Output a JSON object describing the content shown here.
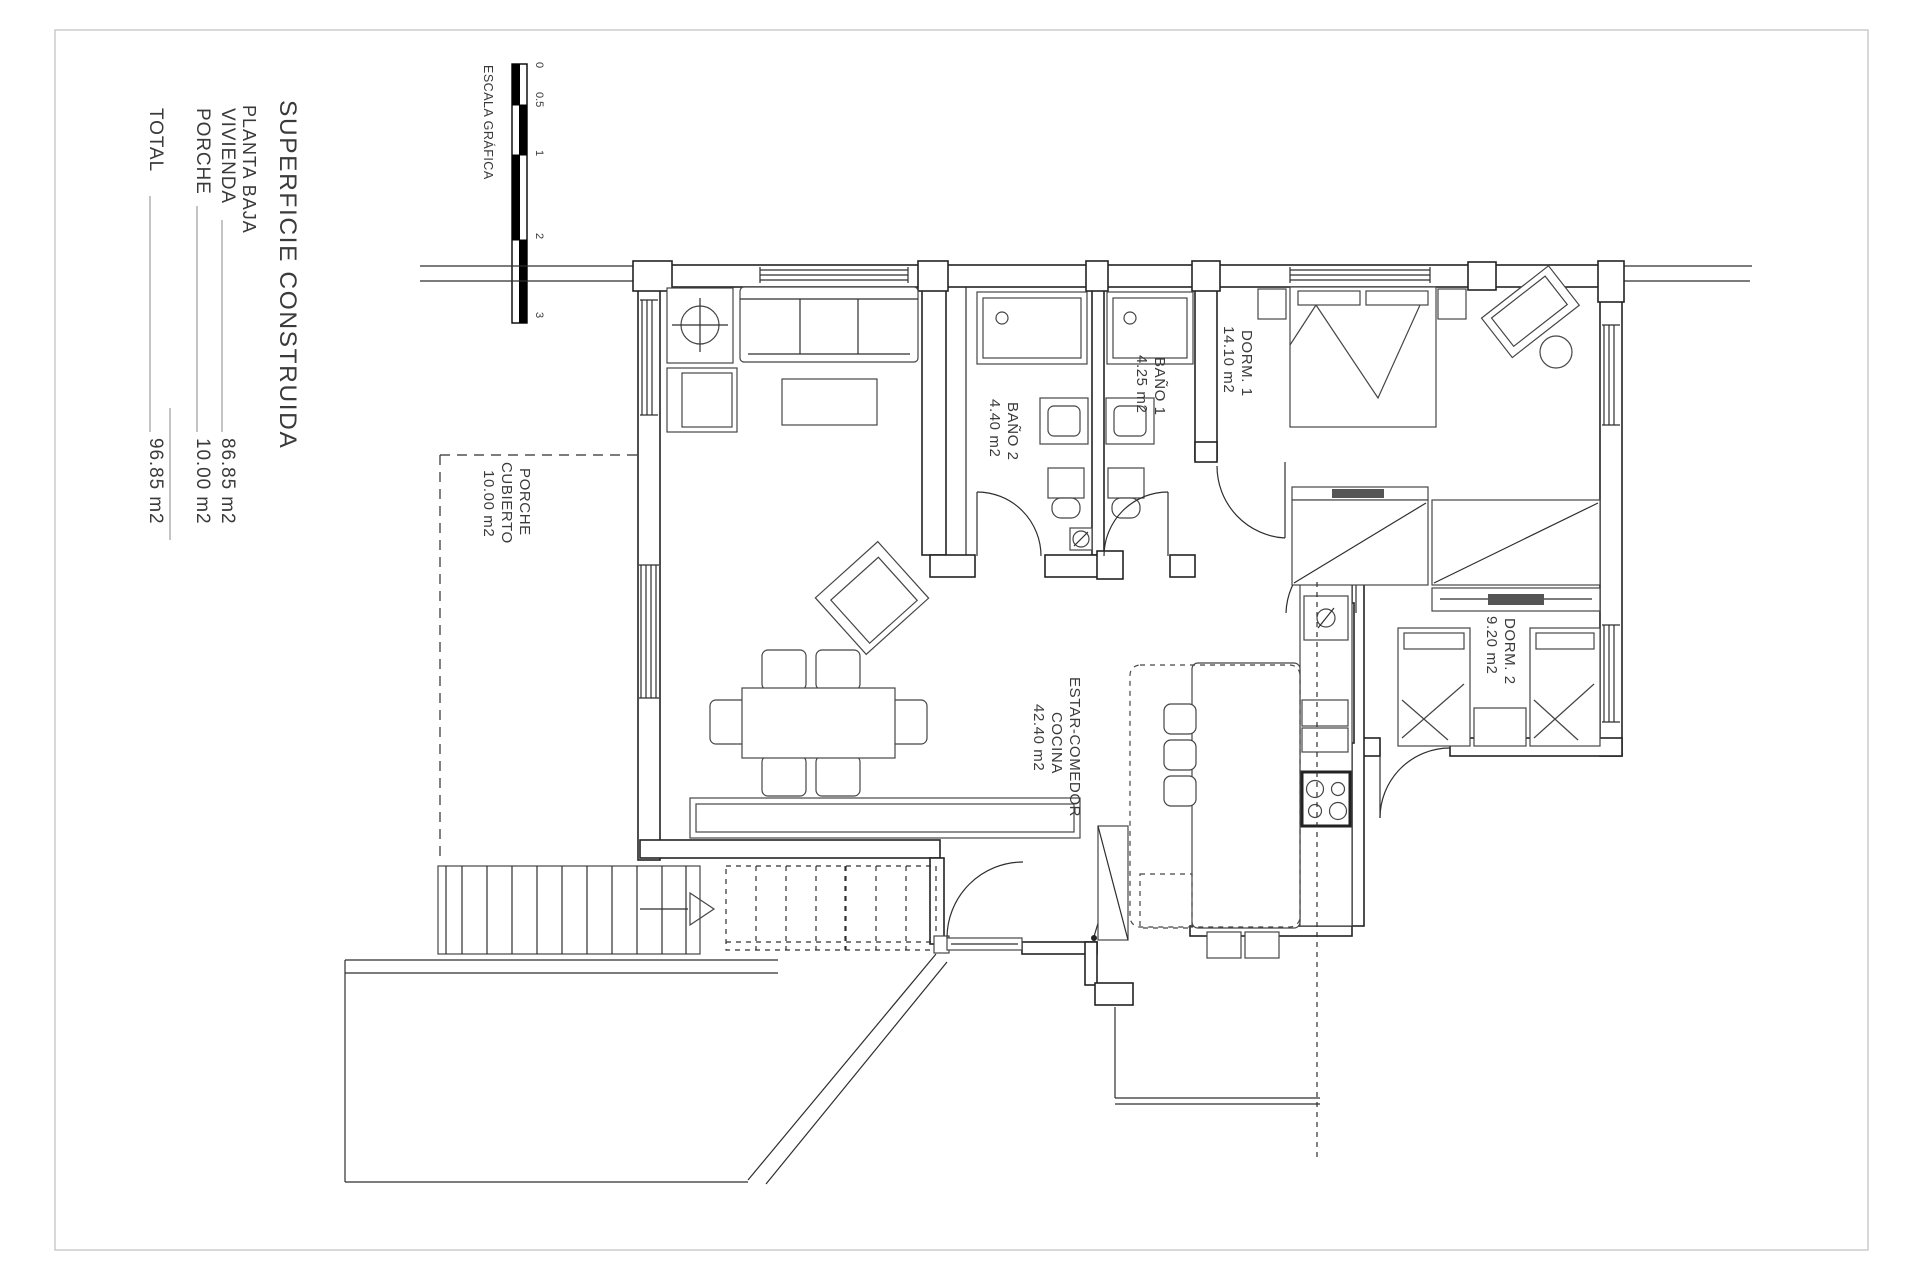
{
  "title_block": {
    "title": "SUPERFICIE CONSTRUIDA",
    "subtitle": "PLANTA BAJA",
    "rows": [
      {
        "label": "VIVIENDA",
        "value": "86.85 m2"
      },
      {
        "label": "PORCHE",
        "value": "10.00 m2"
      },
      {
        "label": "TOTAL",
        "value": "96.85 m2"
      }
    ]
  },
  "scale_bar": {
    "label": "ESCALA GRÁFICA",
    "ticks": [
      "0",
      "0.5",
      "1",
      "2",
      "3"
    ]
  },
  "rooms": [
    {
      "name_line1": "ESTAR-COMEDOR",
      "name_line2": "COCINA",
      "area": "42.40 m2"
    },
    {
      "name": "BAÑO 2",
      "area": "4.40 m2"
    },
    {
      "name": "BAÑO 1",
      "area": "4.25 m2"
    },
    {
      "name": "DORM. 1",
      "area": "14.10 m2"
    },
    {
      "name": "DORM. 2",
      "area": "9.20 m2"
    },
    {
      "name_line1": "PORCHE",
      "name_line2": "CUBIERTO",
      "area": "10.00 m2"
    }
  ],
  "colors": {
    "line": "#2e2e2e",
    "text": "#3a3a3a",
    "frame": "#cccccc",
    "scale_fill": "#000000"
  }
}
